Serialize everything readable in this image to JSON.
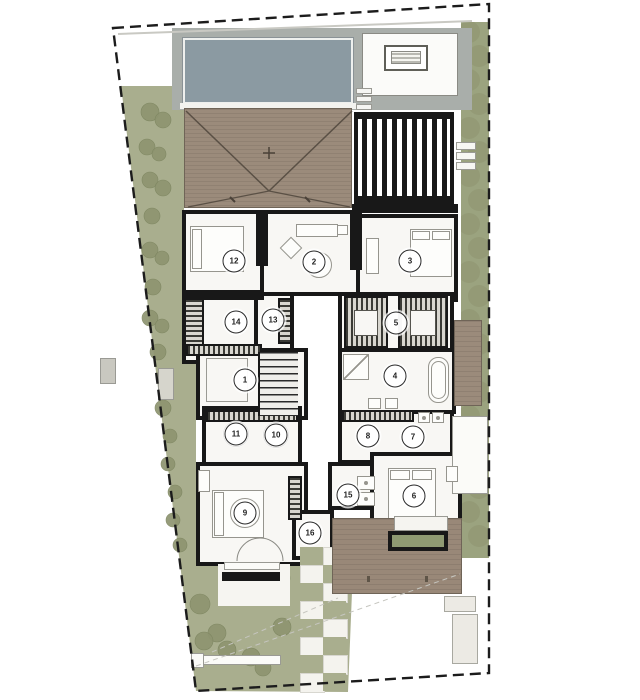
{
  "plan": {
    "type": "architectural-site-floor-plan",
    "description": "villa ground-floor plan with pool, pergola, hip roof, gardens and 16 numbered rooms",
    "room_badges": [
      {
        "n": "1",
        "x": 245,
        "y": 380
      },
      {
        "n": "2",
        "x": 314,
        "y": 262
      },
      {
        "n": "3",
        "x": 410,
        "y": 261
      },
      {
        "n": "4",
        "x": 395,
        "y": 376
      },
      {
        "n": "5",
        "x": 396,
        "y": 323
      },
      {
        "n": "6",
        "x": 414,
        "y": 496
      },
      {
        "n": "7",
        "x": 413,
        "y": 437
      },
      {
        "n": "8",
        "x": 368,
        "y": 436
      },
      {
        "n": "9",
        "x": 245,
        "y": 513
      },
      {
        "n": "10",
        "x": 276,
        "y": 435
      },
      {
        "n": "11",
        "x": 236,
        "y": 434
      },
      {
        "n": "12",
        "x": 234,
        "y": 261
      },
      {
        "n": "13",
        "x": 273,
        "y": 320
      },
      {
        "n": "14",
        "x": 236,
        "y": 322
      },
      {
        "n": "15",
        "x": 348,
        "y": 495
      },
      {
        "n": "16",
        "x": 310,
        "y": 533
      }
    ],
    "palette": {
      "paper": "#ffffff",
      "wall": "#181818",
      "room_fill": "#f8f7f4",
      "pool": "#8b9aa2",
      "pool_deck": "#a9aeaa",
      "roof": "#9b8b7b",
      "wood_deck": "#998878",
      "lawn": "#a9ae8e",
      "shrub": "#8e9470",
      "hedge": "#9ba37f",
      "rug": "#8f9a72",
      "boundary": "#1c1c1c",
      "furniture_line": "#96958e"
    },
    "boundary": {
      "points": "113,28 489,4 489,673 196,691",
      "dash": "11 6"
    },
    "fence_line": {
      "x1": 118,
      "y1": 34,
      "x2": 472,
      "y2": 21
    },
    "landscape": {
      "left_strip_points": "121,86 172,86 172,110 184,110 184,212 182,212 182,362 196,362 196,556 179,556 172,500 152,340 135,200",
      "garden_points": "179,556 298,556 298,542 346,542 346,592 352,592 348,692 196,691",
      "hedge": {
        "x": 461,
        "y": 22,
        "w": 28,
        "h": 536
      },
      "bushes": [
        [
          150,
          112,
          9
        ],
        [
          163,
          120,
          8
        ],
        [
          147,
          147,
          8
        ],
        [
          159,
          154,
          7
        ],
        [
          150,
          180,
          8
        ],
        [
          163,
          188,
          8
        ],
        [
          152,
          216,
          8
        ],
        [
          150,
          250,
          8
        ],
        [
          162,
          258,
          7
        ],
        [
          153,
          287,
          8
        ],
        [
          150,
          318,
          8
        ],
        [
          162,
          326,
          7
        ],
        [
          158,
          352,
          8
        ],
        [
          166,
          380,
          7
        ],
        [
          163,
          408,
          8
        ],
        [
          170,
          436,
          7
        ],
        [
          168,
          464,
          7
        ],
        [
          175,
          492,
          7
        ],
        [
          173,
          520,
          7
        ],
        [
          180,
          545,
          7
        ],
        [
          351,
          96,
          8
        ]
      ],
      "garden_trees": [
        [
          200,
          604,
          10
        ],
        [
          217,
          633,
          9
        ],
        [
          204,
          641,
          9
        ],
        [
          227,
          650,
          9
        ],
        [
          251,
          657,
          9
        ],
        [
          263,
          668,
          8
        ],
        [
          281,
          578,
          9
        ],
        [
          334,
          578,
          9
        ],
        [
          282,
          627,
          9
        ],
        [
          333,
          628,
          9
        ]
      ]
    },
    "pergola": {
      "slats": 9,
      "slat_start": 8,
      "slat_step": 10
    },
    "path_tiles": {
      "x": 300,
      "y": 547,
      "cols": 2,
      "rows": 8,
      "tw": 23,
      "th": 18
    },
    "deck_marks": [
      [
        367,
        576
      ],
      [
        425,
        576
      ]
    ],
    "sight_lines": [
      {
        "x1": 196,
        "y1": 666,
        "x2": 460,
        "y2": 574
      },
      {
        "x1": 212,
        "y1": 652,
        "x2": 338,
        "y2": 598
      }
    ],
    "door_arcs": [
      {
        "d": "M237,561 A23,23 0 0 1 260,538"
      },
      {
        "d": "M283,561 A23,23 0 0 0 260,538"
      }
    ]
  }
}
